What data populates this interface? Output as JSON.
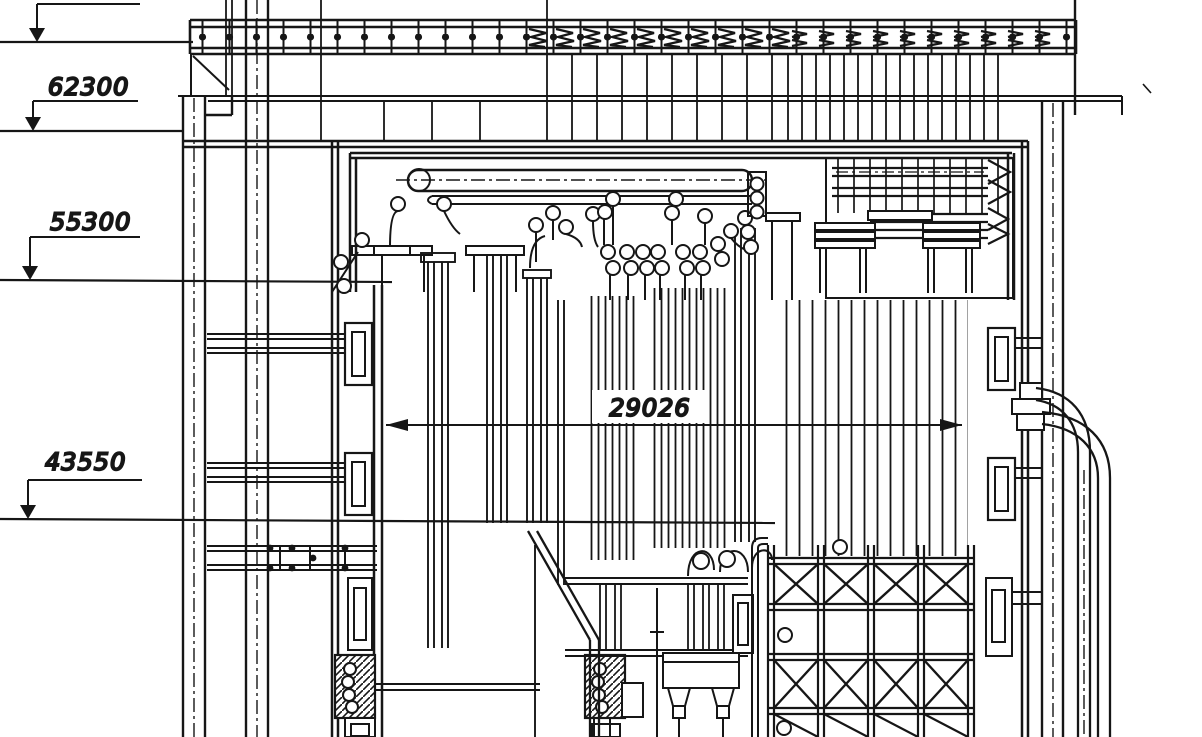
{
  "colors": {
    "paper": "#ffffff",
    "ink": "#161616"
  },
  "labels": {
    "elevation_62300": "62300",
    "elevation_55300": "55300",
    "elevation_43550": "43550",
    "width_29026": "29026"
  }
}
